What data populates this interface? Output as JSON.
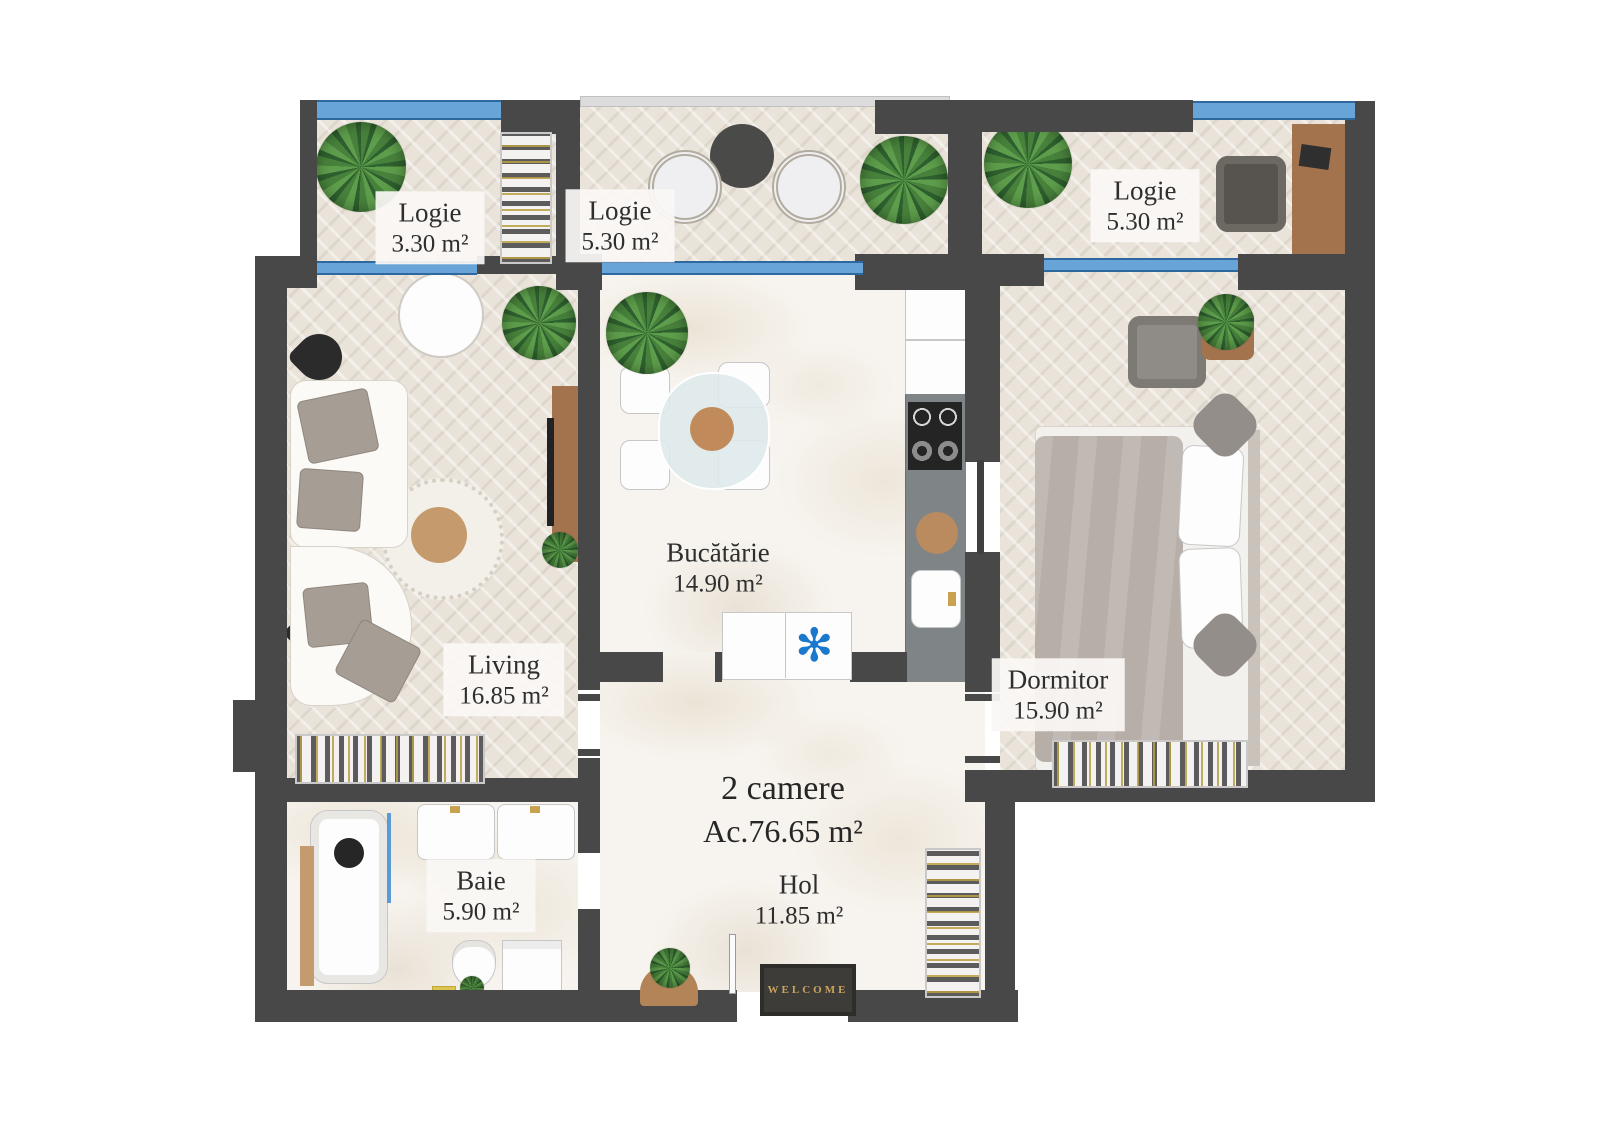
{
  "plan": {
    "title": "2 camere",
    "total_area": "Ac.76.65 m²"
  },
  "rooms": [
    {
      "key": "logie-left",
      "name": "Logie",
      "area": "3.30 m²"
    },
    {
      "key": "logie-middle",
      "name": "Logie",
      "area": "5.30 m²"
    },
    {
      "key": "logie-right",
      "name": "Logie",
      "area": "5.30 m²"
    },
    {
      "key": "living",
      "name": "Living",
      "area": "16.85 m²"
    },
    {
      "key": "bucatarie",
      "name": "Bucătărie",
      "area": "14.90 m²"
    },
    {
      "key": "dormitor",
      "name": "Dormitor",
      "area": "15.90 m²"
    },
    {
      "key": "baie",
      "name": "Baie",
      "area": "5.90 m²"
    },
    {
      "key": "hol",
      "name": "Hol",
      "area": "11.85 m²"
    }
  ],
  "entrance": {
    "mat_text": "WELCOME"
  },
  "icons": {
    "ac_asterisk": "✻"
  },
  "colors": {
    "wall": "#484848",
    "window_blue": "#69a4d9",
    "ac_blue": "#1a79cc",
    "mat_gold": "#c9a45c"
  }
}
